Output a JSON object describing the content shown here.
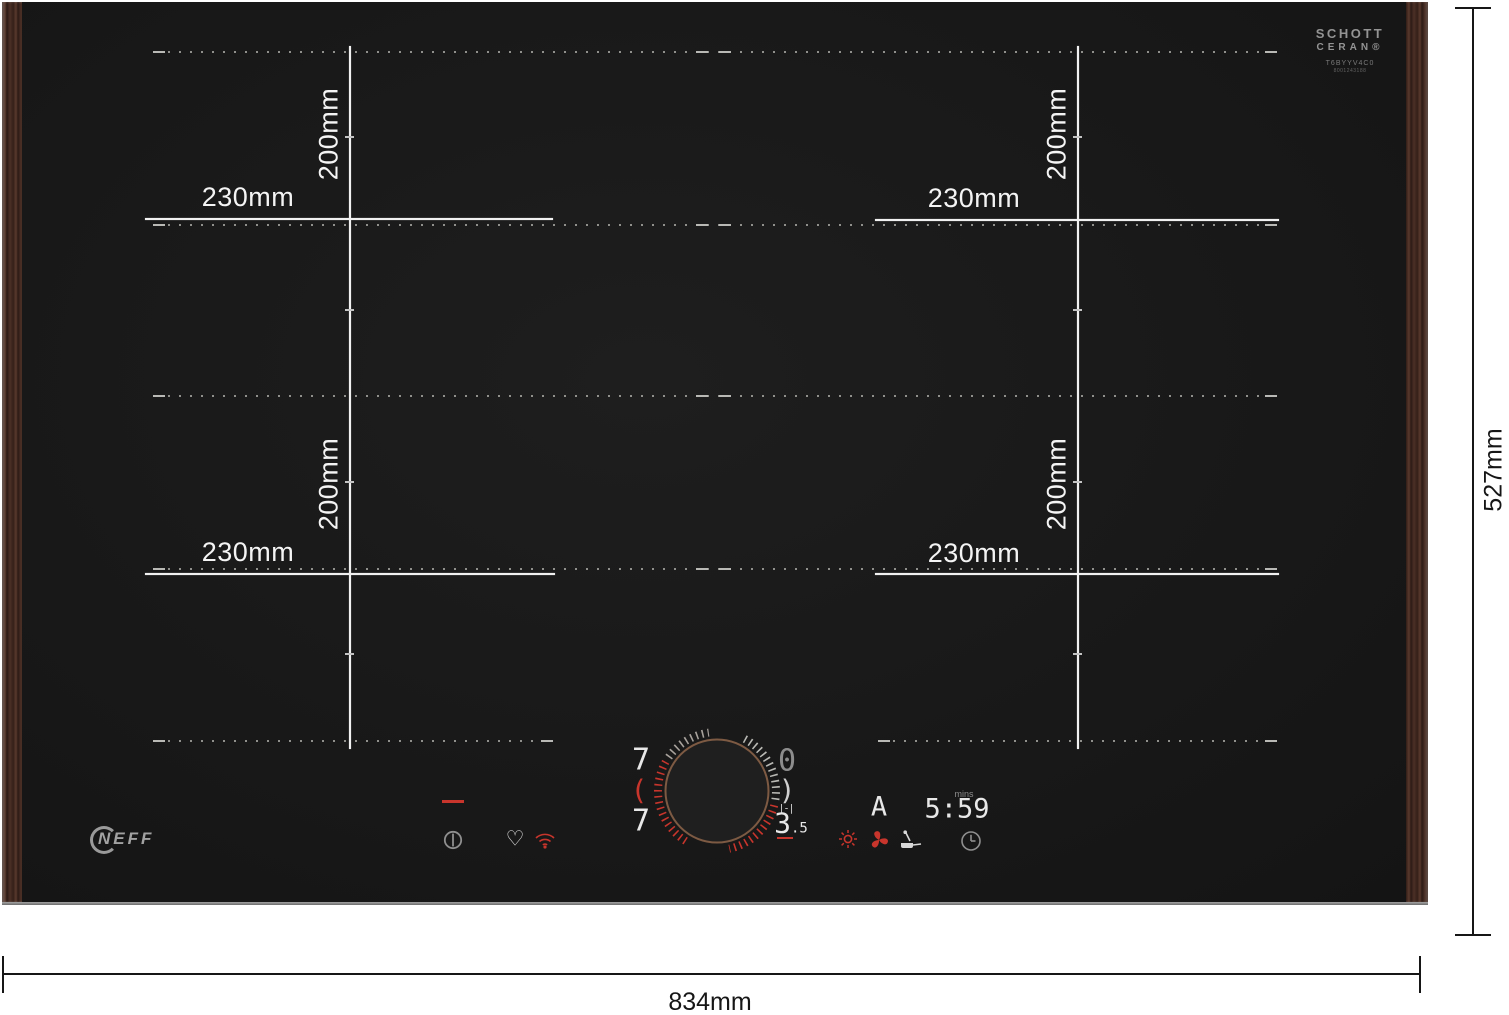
{
  "branding": {
    "brand": "NEFF",
    "glass_logo_line1": "SCHOTT",
    "glass_logo_line2": "CERAN®",
    "model": "T6BYYV4C0",
    "model_code": "8001243188"
  },
  "dimensions": {
    "width_total": "834mm",
    "depth_total": "527mm",
    "zone_width_labels": [
      "230mm",
      "230mm",
      "230mm",
      "230mm"
    ],
    "zone_depth_labels": [
      "200mm",
      "200mm",
      "200mm",
      "200mm"
    ]
  },
  "display": {
    "left_top_level": "7",
    "left_link_bracket": "(",
    "left_bottom_level": "7",
    "right_top_level": "0",
    "right_link_bracket": ")",
    "bridge_symbol": "|-|",
    "power_level_main": "3",
    "power_level_suffix": ".5",
    "auto_indicator": "A",
    "timer_unit": "mins",
    "timer_value": "5:59",
    "heart_glyph": "♡"
  },
  "icon_names": {
    "status_bar": "red-dash",
    "power": "power-icon",
    "favorite": "heart-icon",
    "wifi": "wifi-icon",
    "power_move": "sun-icon",
    "hood_control": "fan-icon",
    "frying_sensor": "pan-thermometer-icon",
    "timer": "clock-icon"
  },
  "colors": {
    "accent_red": "#c8352c",
    "glass_black": "#181818",
    "wood_brown": "#4c3026",
    "marking_white": "#f1f1f1"
  }
}
